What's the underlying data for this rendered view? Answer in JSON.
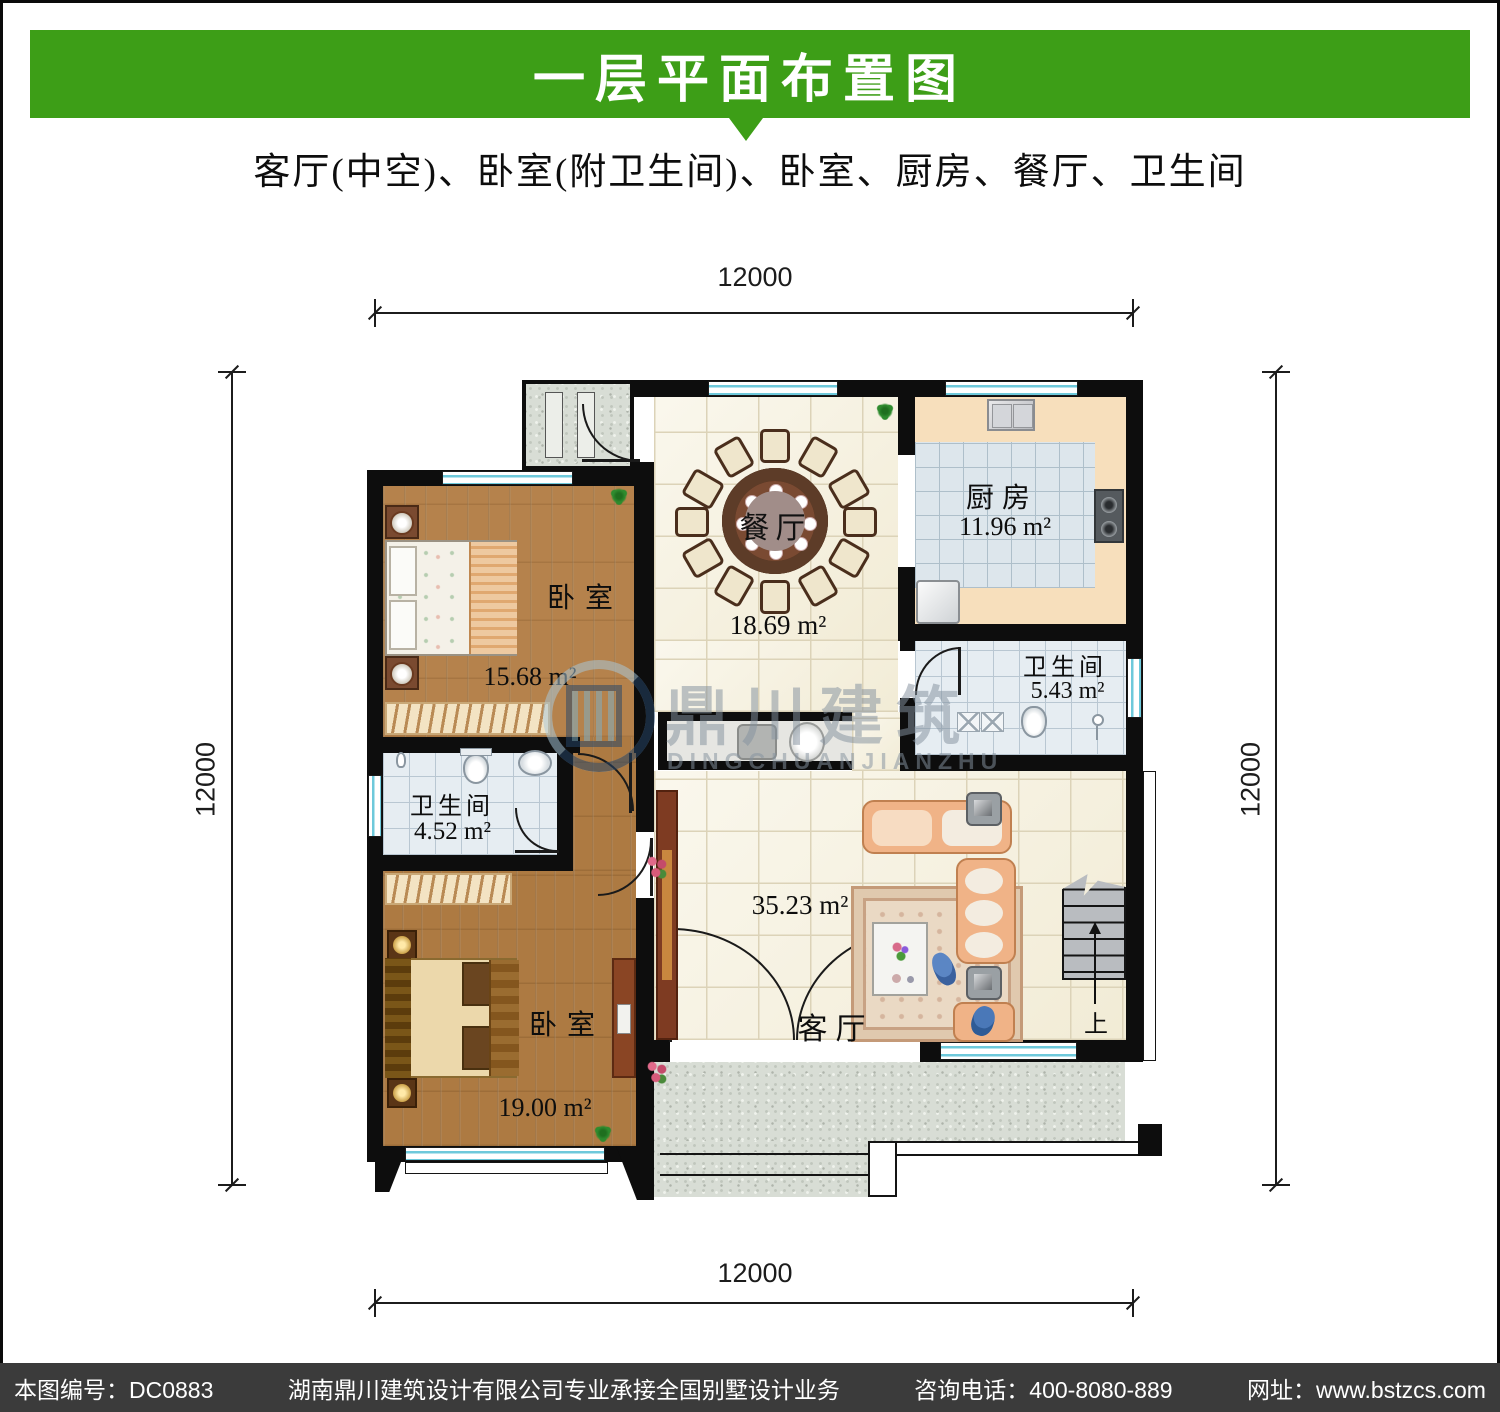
{
  "header": {
    "title": "一层平面布置图",
    "bg_color": "#3d9e17",
    "text_color": "#ffffff"
  },
  "subtitle": "客厅(中空)、卧室(附卫生间)、卧室、厨房、餐厅、卫生间",
  "dimensions": {
    "top": "12000",
    "bottom": "12000",
    "left": "12000",
    "right": "12000"
  },
  "rooms": {
    "dining": {
      "name": "餐厅",
      "area": "18.69 m²"
    },
    "kitchen": {
      "name": "厨房",
      "area": "11.96 m²"
    },
    "bath_right": {
      "name": "卫生间",
      "area": "5.43 m²"
    },
    "bedroom_top": {
      "name": "卧室",
      "area": "15.68 m²"
    },
    "bath_left": {
      "name": "卫生间",
      "area": "4.52 m²"
    },
    "bedroom_bottom": {
      "name": "卧室",
      "area": "19.00 m²"
    },
    "living": {
      "name": "客厅",
      "area": "35.23 m²"
    }
  },
  "stairs": {
    "label": "上"
  },
  "watermark": {
    "cn": "鼎川建筑",
    "en": "DINGCHUANJIANZHU"
  },
  "footer": {
    "bg_color": "#3b3b3b",
    "items": [
      "本图编号：DC0883",
      "湖南鼎川建筑设计有限公司专业承接全国别墅设计业务",
      "咨询电话：400-8080-889",
      "网址：www.bstzcs.com"
    ]
  },
  "colors": {
    "wall": "#0d0d0d",
    "window_stripe": "#6ec9db",
    "wood_floor": "#b5824c",
    "tile_floor": "#f6f1de",
    "bath_tile": "#e6edf2",
    "kitchen_counter": "#f7dfbc",
    "porch_granite": "#d8ddd5",
    "stairs_gray": "#b9bcc0",
    "sofa_peach": "#efb286",
    "rug": "#ead9c4",
    "table_brown": "#5d3c28",
    "watermark": "#85929f"
  }
}
